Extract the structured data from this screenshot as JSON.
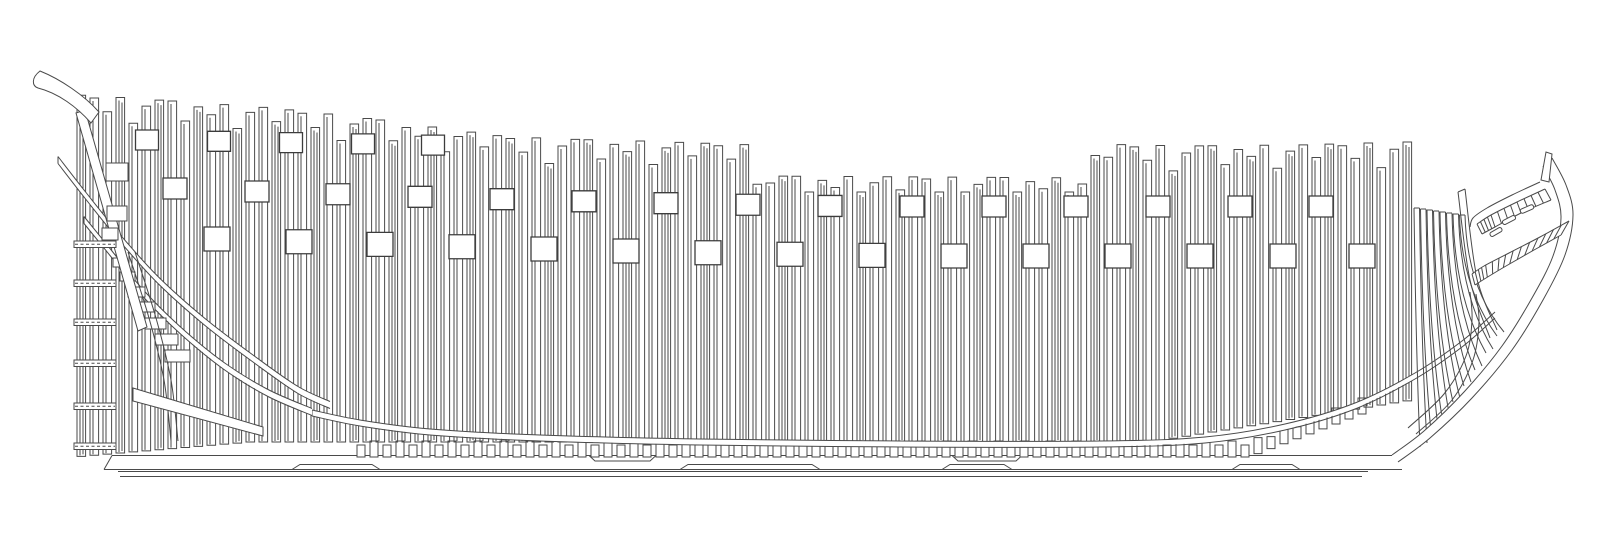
{
  "diagram": {
    "canvas": {
      "width": 1600,
      "height": 542,
      "background": "#ffffff"
    },
    "style": {
      "stroke": "#4a4a4a",
      "stroke_strong": "#3c3c3c",
      "line_width": 1,
      "port_line_width": 1.3,
      "fill_white": "#ffffff"
    },
    "frames": {
      "x_start": 77,
      "pitch": 13,
      "count": 103,
      "width": 8.6,
      "sheer_points": [
        [
          77,
          95
        ],
        [
          130,
          98
        ],
        [
          200,
          103
        ],
        [
          260,
          107
        ],
        [
          320,
          113
        ],
        [
          380,
          120
        ],
        [
          440,
          128
        ],
        [
          500,
          136
        ],
        [
          560,
          139
        ],
        [
          640,
          141
        ],
        [
          755,
          145
        ],
        [
          760,
          176
        ],
        [
          1090,
          178
        ],
        [
          1098,
          144
        ],
        [
          1180,
          146
        ],
        [
          1300,
          145
        ],
        [
          1404,
          142
        ]
      ],
      "jag_cycle": [
        0,
        2,
        15,
        0,
        25,
        7,
        0,
        0,
        19,
        4,
        11,
        0,
        23,
        6,
        0,
        13
      ],
      "top_cap": 192,
      "bottom": {
        "flat_y": 442,
        "stern_knee_x": 250,
        "stern_slope": 0.085,
        "bow_knee_x": 1150,
        "bow_slope": 0.16
      },
      "inner_line_inset": 3,
      "second_line_inset": 6,
      "second_line_every": 3
    },
    "gunports": {
      "rows": [
        {
          "name": "upper",
          "x_centers": [
            147,
            219,
            291,
            363,
            433
          ],
          "w": 23,
          "h": 20,
          "y_mode": "linear",
          "y_base": 130,
          "x_ref": 147,
          "y_slope": 0.018
        },
        {
          "name": "middle",
          "x_centers": [
            175,
            257,
            338,
            420,
            502,
            584,
            666,
            748,
            830,
            912,
            994,
            1076,
            1158,
            1240,
            1321
          ],
          "w": 24,
          "h": 21,
          "y_mode": "dip",
          "y_flat": 196,
          "dip": 18,
          "dip_ref": 900,
          "dip_span": 725,
          "exp": 1.5
        },
        {
          "name": "lower",
          "x_centers": [
            217,
            299,
            380,
            462,
            544,
            626,
            708,
            790,
            872,
            954,
            1036,
            1118,
            1200,
            1283,
            1362
          ],
          "w": 26,
          "h": 24,
          "y_mode": "dip",
          "y_flat": 244,
          "dip": 17,
          "dip_ref": 950,
          "dip_span": 733,
          "exp": 1.5
        }
      ]
    },
    "keel": {
      "top": {
        "y": 455.5,
        "x1": 112,
        "x2": 1392
      },
      "bottom": {
        "y": 469.5,
        "x1": 104,
        "x2": 1402
      },
      "false_keel": [
        {
          "y": 471.5,
          "x1": 118,
          "x2": 1368
        },
        {
          "y": 476.5,
          "x1": 120,
          "x2": 1362
        }
      ],
      "scarphs_top": [
        [
          595,
          650
        ],
        [
          958,
          1016
        ]
      ],
      "scarphs_bottom": [
        [
          300,
          372
        ],
        [
          688,
          812
        ],
        [
          950,
          1004
        ],
        [
          1240,
          1292
        ]
      ]
    },
    "chocks": {
      "x_start": 357,
      "x_end": 1368,
      "pitch": 13,
      "width": 8,
      "heights": [
        12,
        16
      ],
      "base_y": 457,
      "rise_start_x": 1245,
      "rise_slope": 0.38
    },
    "ribband": {
      "width": 6,
      "points": [
        [
          312,
          413
        ],
        [
          360,
          423
        ],
        [
          430,
          432
        ],
        [
          540,
          438
        ],
        [
          700,
          442
        ],
        [
          900,
          444
        ],
        [
          1100,
          444
        ],
        [
          1205,
          440
        ],
        [
          1285,
          427
        ],
        [
          1355,
          406
        ],
        [
          1415,
          376
        ],
        [
          1462,
          344
        ],
        [
          1495,
          315
        ]
      ]
    },
    "stern": {
      "bands": [
        {
          "w": 7,
          "points": [
            [
              84,
              220
            ],
            [
              110,
              252
            ],
            [
              142,
              292
            ],
            [
              180,
              330
            ],
            [
              224,
              366
            ],
            [
              268,
              393
            ],
            [
              312,
              412
            ]
          ]
        },
        {
          "w": 7,
          "points": [
            [
              58,
              160
            ],
            [
              86,
              196
            ],
            [
              120,
              238
            ],
            [
              158,
              280
            ],
            [
              205,
              322
            ],
            [
              255,
              360
            ],
            [
              298,
              390
            ],
            [
              330,
              405
            ]
          ]
        }
      ],
      "gudgeons": {
        "x": 74,
        "w": 42,
        "h": 6.5,
        "ys": [
          241,
          280,
          319,
          360,
          403,
          443
        ],
        "dash": "3,2.5"
      },
      "counter_timber": [
        [
          76,
          113
        ],
        [
          85,
          110
        ],
        [
          147,
          327
        ],
        [
          138,
          331
        ]
      ],
      "horn_path": "M40,71 C60,79 84,95 99,112 L91,123 C77,107 58,93 38,88 C32,86 31,78 40,71 Z",
      "step_chocks": [
        [
          113,
          258,
          13,
          9
        ],
        [
          120,
          272,
          15,
          9
        ],
        [
          128,
          287,
          17,
          10
        ],
        [
          136,
          302,
          19,
          10
        ],
        [
          145,
          318,
          21,
          11
        ],
        [
          155,
          334,
          23,
          11
        ],
        [
          165,
          350,
          25,
          12
        ]
      ],
      "wedge": [
        [
          133,
          388
        ],
        [
          263,
          427
        ],
        [
          263,
          436
        ],
        [
          133,
          401
        ]
      ],
      "fashion_curves": [
        [
          [
            128,
            252
          ],
          [
            149,
            318
          ],
          [
            164,
            380
          ],
          [
            171,
            441
          ]
        ],
        [
          [
            135,
            252
          ],
          [
            156,
            318
          ],
          [
            171,
            380
          ],
          [
            178,
            441
          ]
        ]
      ],
      "detail_blocks": [
        [
          106,
          163,
          22,
          18
        ],
        [
          107,
          206,
          20,
          15
        ],
        [
          102,
          228,
          16,
          12
        ]
      ]
    },
    "bow": {
      "stem_outer": [
        [
          1398,
          462
        ],
        [
          1430,
          438
        ],
        [
          1472,
          398
        ],
        [
          1512,
          350
        ],
        [
          1543,
          300
        ],
        [
          1565,
          255
        ],
        [
          1573,
          215
        ],
        [
          1566,
          185
        ],
        [
          1552,
          158
        ]
      ],
      "stem_inner": [
        [
          1392,
          455
        ],
        [
          1424,
          431
        ],
        [
          1464,
          392
        ],
        [
          1502,
          346
        ],
        [
          1532,
          298
        ],
        [
          1553,
          256
        ],
        [
          1561,
          218
        ],
        [
          1555,
          190
        ],
        [
          1543,
          166
        ]
      ],
      "head_curve": [
        [
          1540,
          182
        ],
        [
          1512,
          195
        ],
        [
          1487,
          208
        ],
        [
          1473,
          218
        ],
        [
          1470,
          227
        ]
      ],
      "ladders": [
        {
          "rungs": 13,
          "outer": [
            [
              1545,
              189
            ],
            [
              1517,
              202
            ],
            [
              1491,
              215
            ],
            [
              1477,
              224
            ]
          ],
          "inner": [
            [
              1551,
              200
            ],
            [
              1521,
              213
            ],
            [
              1495,
              227
            ],
            [
              1482,
              234
            ]
          ]
        },
        {
          "rungs": 16,
          "outer": [
            [
              1569,
              221
            ],
            [
              1540,
              237
            ],
            [
              1509,
              253
            ],
            [
              1484,
              266
            ],
            [
              1472,
              274
            ]
          ],
          "inner": [
            [
              1561,
              235
            ],
            [
              1534,
              250
            ],
            [
              1506,
              266
            ],
            [
              1486,
              278
            ],
            [
              1475,
              285
            ]
          ]
        }
      ],
      "apron_curves": [
        [
          [
            1408,
            428
          ],
          [
            1444,
            394
          ],
          [
            1466,
            356
          ],
          [
            1472,
            320
          ],
          [
            1470,
            292
          ]
        ],
        [
          [
            1416,
            434
          ],
          [
            1452,
            400
          ],
          [
            1473,
            360
          ],
          [
            1479,
            322
          ],
          [
            1476,
            294
          ]
        ]
      ],
      "horn": [
        [
          1541,
          180
        ],
        [
          1546,
          152
        ],
        [
          1552,
          154
        ],
        [
          1549,
          182
        ]
      ],
      "hawse_slots": [
        {
          "cx": 1527,
          "cy": 209,
          "w": 14,
          "h": 4.5,
          "angle": -24
        },
        {
          "cx": 1509,
          "cy": 220,
          "w": 14,
          "h": 4.5,
          "angle": -27
        },
        {
          "cx": 1496,
          "cy": 232,
          "w": 13,
          "h": 4.5,
          "angle": -30
        }
      ],
      "knuckle_frame": {
        "lines": [
          [
            [
              1458,
              192
            ],
            [
              1470,
              280
            ],
            [
              1490,
              338
            ]
          ],
          [
            [
              1465,
              189
            ],
            [
              1477,
              278
            ],
            [
              1497,
              330
            ]
          ]
        ],
        "cap": [
          [
            1458,
            192
          ],
          [
            1465,
            189
          ]
        ]
      },
      "cant_frames": {
        "strip_w": 5.5,
        "bend": 0.6,
        "list": [
          [
            1414,
            208,
            1420,
            447
          ],
          [
            1420.5,
            209,
            1431,
            432
          ],
          [
            1427,
            210,
            1442,
            417
          ],
          [
            1433.5,
            211,
            1453,
            402
          ],
          [
            1440,
            212,
            1464,
            386
          ],
          [
            1446.5,
            213,
            1475,
            370
          ],
          [
            1453,
            214,
            1486,
            353
          ],
          [
            1459.5,
            215,
            1497,
            336
          ]
        ]
      }
    }
  }
}
